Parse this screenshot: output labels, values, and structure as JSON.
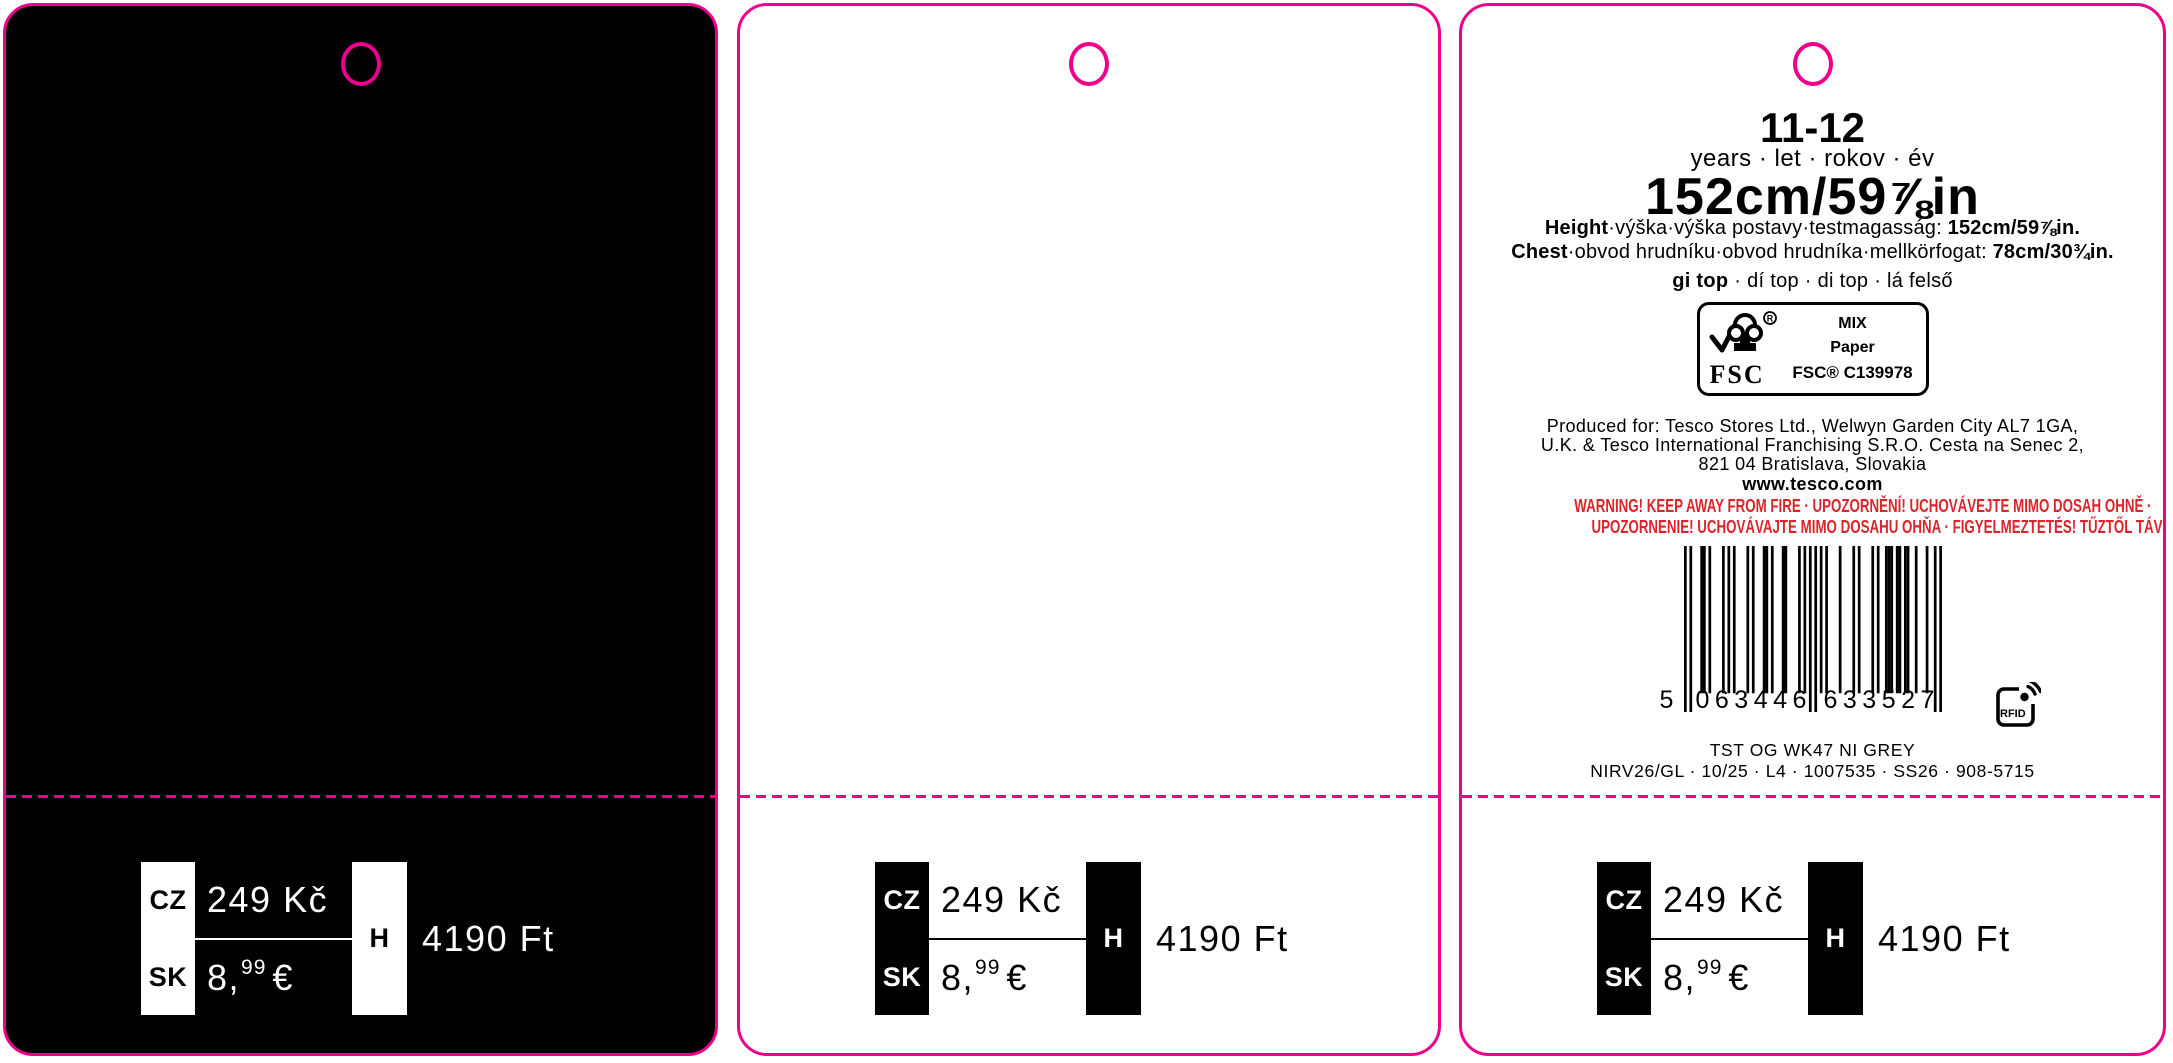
{
  "colors": {
    "magenta": "#EC008C",
    "warning_red": "#D8262C",
    "black": "#000000",
    "white": "#FFFFFF"
  },
  "size_info": {
    "age": "11-12",
    "age_units": "years · let · rokov · év",
    "height_big": "152cm/59⅞in",
    "height_label": "Height",
    "height_middle": "·výška·výška postavy·testmagasság: ",
    "height_value": "152cm/59⅞in.",
    "chest_label": "Chest",
    "chest_middle": "·obvod hrudníku·obvod hrudníka·mellkörfogat: ",
    "chest_value": "78cm/30¾in.",
    "product_bold": "gi top",
    "product_rest": " · dí top · di top · lá felső"
  },
  "fsc": {
    "logo_text": "FSC",
    "reg": "R",
    "mix": "MIX",
    "paper": "Paper",
    "license": "FSC® C139978"
  },
  "producer": {
    "line1": "Produced for: Tesco Stores Ltd., Welwyn Garden City AL7 1GA,",
    "line2": "U.K. & Tesco International Franchising S.R.O. Cesta na Senec 2,",
    "line3": "821 04 Bratislava, Slovakia",
    "website": "www.tesco.com"
  },
  "warning": {
    "line1": "WARNING! KEEP AWAY FROM FIRE · UPOZORNĚNÍ! UCHOVÁVEJTE MIMO DOSAH OHNĚ ·",
    "line2": "UPOZORNENIE! UCHOVÁVAJTE MIMO DOSAHU OHŇA · FIGYELMEZTETÉS! TŰZTŐL TÁVOL TARTANDÓ"
  },
  "barcode": {
    "digits": "5063446633527",
    "display_first": "5",
    "display_left": "063446",
    "display_right": "633527"
  },
  "rfid_label": "RFID",
  "product_meta": {
    "style": "TST OG WK47 NI GREY",
    "codes": "NIRV26/GL · 10/25 · L4 · 1007535 · SS26 · 908-5715"
  },
  "price": {
    "cz_label": "CZ",
    "cz_value": "249 Kč",
    "sk_label": "SK",
    "eur_main": "8,",
    "eur_cents": "99",
    "eur_symbol": "€",
    "h_label": "H",
    "h_value": "4190 Ft"
  }
}
